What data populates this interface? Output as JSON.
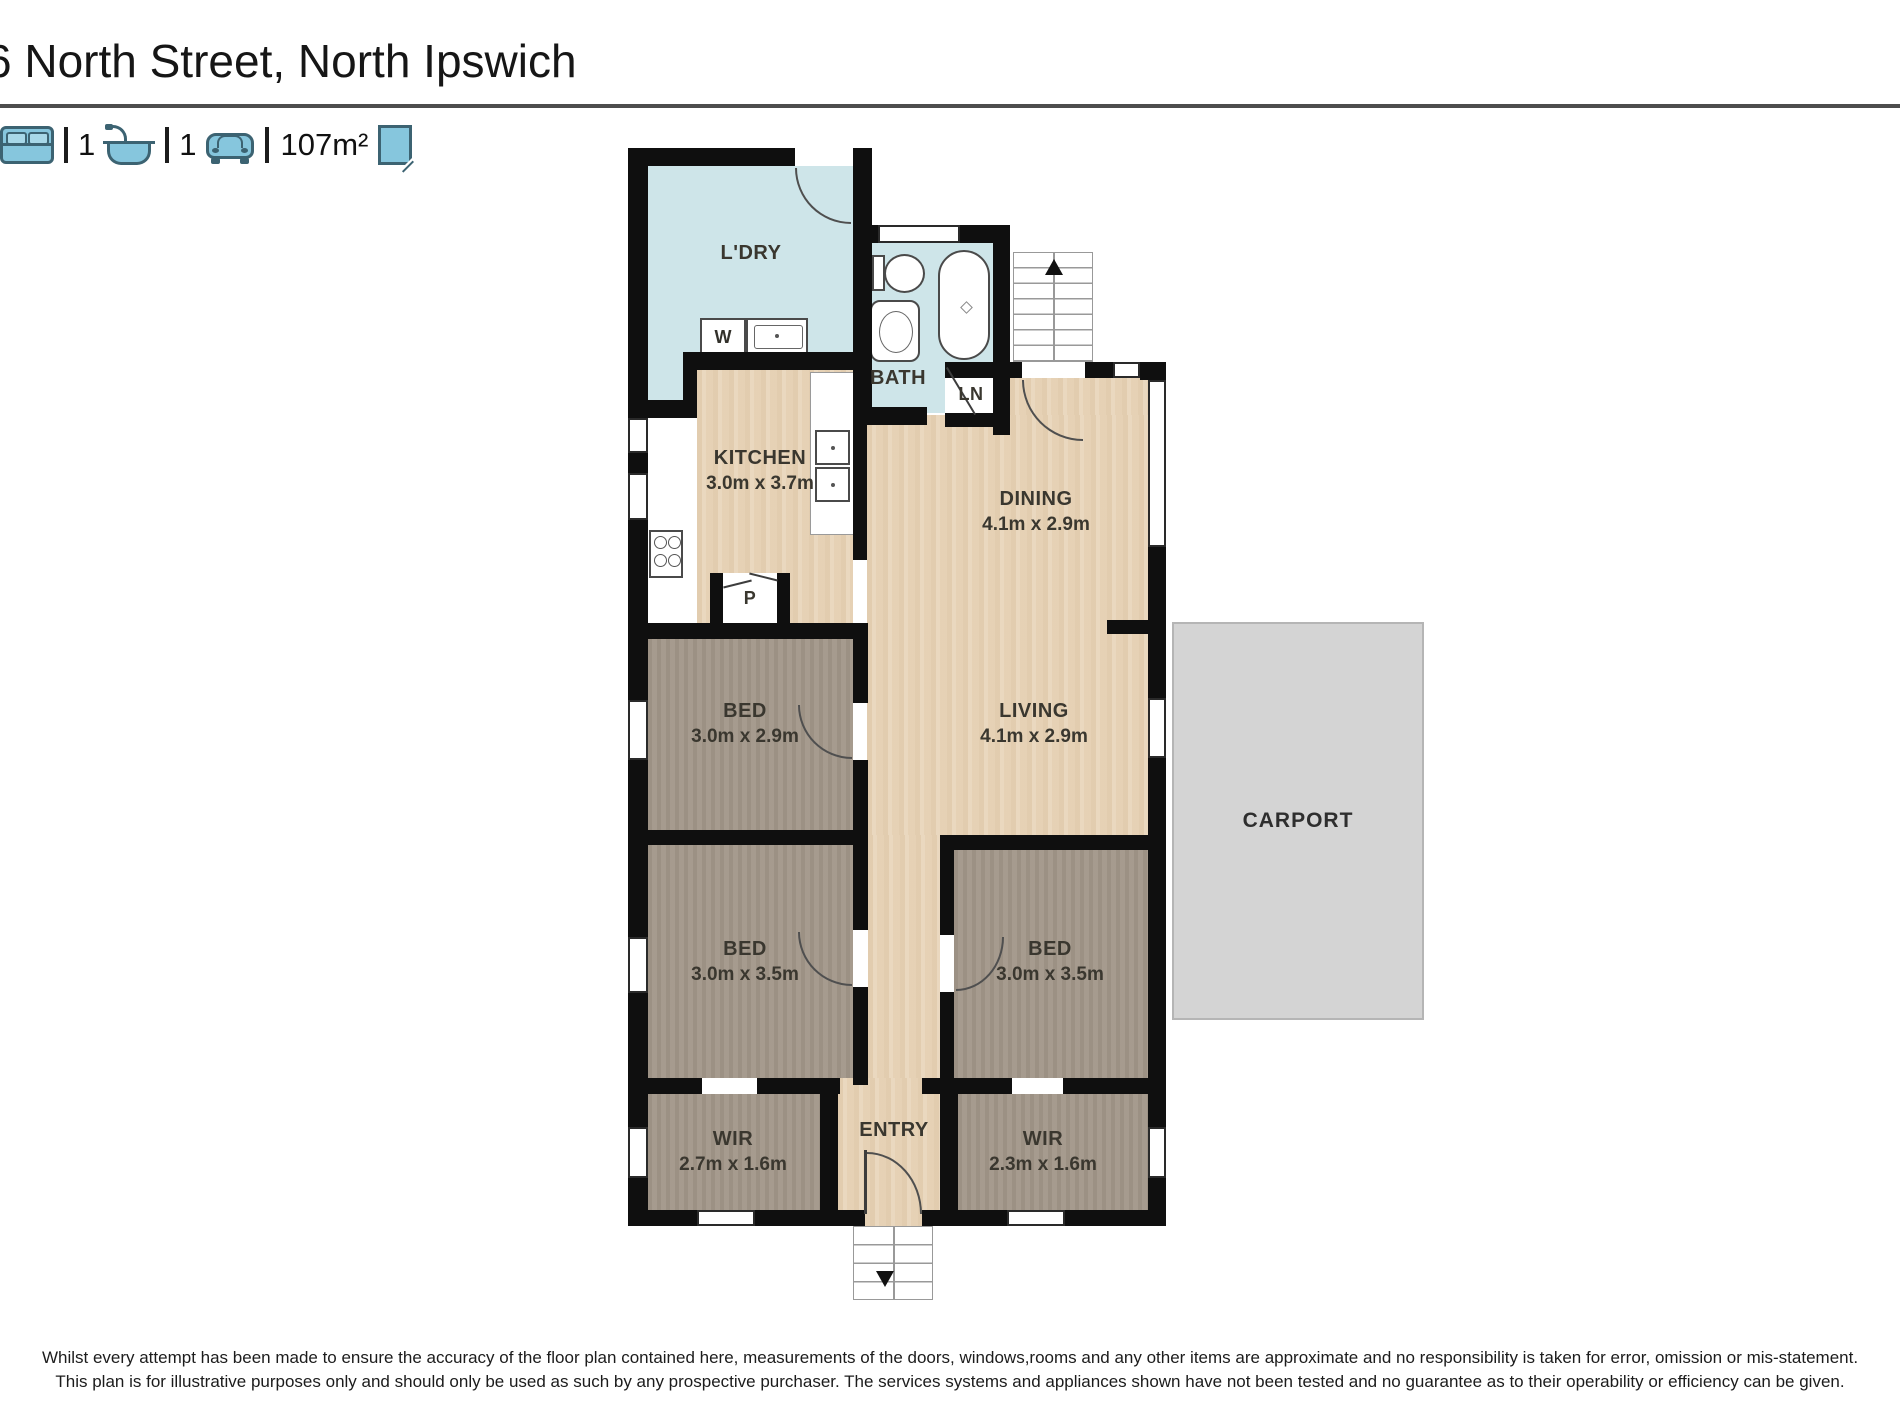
{
  "header": {
    "title": "6 North Street, North Ipswich",
    "stats": {
      "beds_value": "",
      "baths_value": "1",
      "cars_value": "1",
      "area_value": "107m²"
    }
  },
  "floorplan": {
    "laundry": {
      "label": "L'DRY"
    },
    "washer": {
      "label": "W"
    },
    "bath": {
      "label": "BATH"
    },
    "linen": {
      "label": "LN"
    },
    "kitchen": {
      "label": "KITCHEN",
      "dims": "3.0m x 3.7m"
    },
    "pantry": {
      "label": "P"
    },
    "dining": {
      "label": "DINING",
      "dims": "4.1m x 2.9m"
    },
    "living": {
      "label": "LIVING",
      "dims": "4.1m x 2.9m"
    },
    "bed1": {
      "label": "BED",
      "dims": "3.0m x 2.9m"
    },
    "bed2": {
      "label": "BED",
      "dims": "3.0m x 3.5m"
    },
    "bed3": {
      "label": "BED",
      "dims": "3.0m x 3.5m"
    },
    "wir1": {
      "label": "WIR",
      "dims": "2.7m x 1.6m"
    },
    "wir2": {
      "label": "WIR",
      "dims": "2.3m x 1.6m"
    },
    "entry": {
      "label": "ENTRY"
    },
    "carport": {
      "label": "CARPORT"
    }
  },
  "disclaimer": {
    "line1": "Whilst every attempt has been made to ensure the accuracy of the floor plan contained here, measurements of the doors, windows,rooms and any other items are approximate and no responsibility is taken for error, omission or mis-statement.",
    "line2": "This plan is for illustrative purposes only and should only be used as such by any prospective purchaser. The services systems and appliances shown have not been tested and no guarantee as to their operability or efficiency can be given."
  },
  "colors": {
    "icon_fill": "#86c6dd",
    "icon_stroke": "#3c6372",
    "wet_room_floor": "#cee5e9",
    "timber_floor": "#e9d6bb",
    "bedroom_floor": "#a2978a",
    "carport_fill": "#d4d4d4",
    "wall": "#0f0f0f"
  }
}
